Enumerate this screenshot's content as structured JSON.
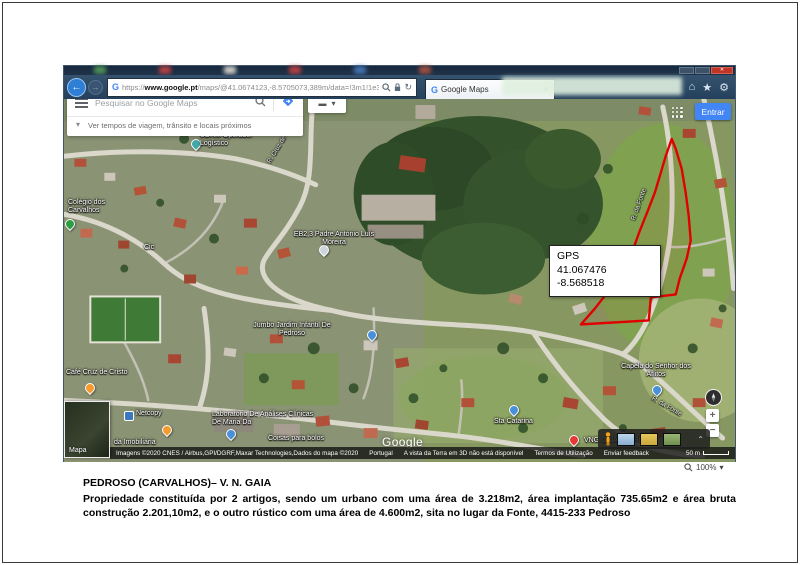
{
  "browser": {
    "url_scheme": "https://",
    "url_domain": "www.google.pt",
    "url_path": "/maps/@41.0674123,-8.5705073,389m/data=!3m1!1e3?hl=pt-PT",
    "tab_title": "Google Maps",
    "icons": {
      "refresh": "↻",
      "home": "⌂",
      "star": "★",
      "gear": "⚙",
      "caret": "▾",
      "tab_close": "✕",
      "window_close": "✕",
      "back_arrow": "←",
      "fwd_arrow": "→",
      "chevron_up": "⌃",
      "chevron_down": "▾",
      "dash": "▬"
    }
  },
  "maps_ui": {
    "search_placeholder": "Pesquisar no Google Maps",
    "travel_hint": "Ver tempos de viagem, trânsito e locais próximos",
    "signin_label": "Entrar",
    "map_inset_label": "Mapa",
    "watermark": "Google",
    "zoom_in": "+",
    "zoom_out": "−",
    "attribution_imagery": "Imagens ©2020 CNES / Airbus,GPI/DGRF,Maxar Technologies,Dados do mapa ©2020",
    "attribution_country": "Portugal",
    "attribution_3d": "A vista da Terra em 3D não está disponível",
    "terms": "Termos de Utilização",
    "feedback": "Enviar feedback",
    "scale": "50 m",
    "ie_zoom_level": "100%"
  },
  "gps_box": {
    "title": "GPS",
    "lat": "41.067476",
    "lng": "-8.568518"
  },
  "map_labels": [
    {
      "text": "UDHM Operador Logístico"
    },
    {
      "text": "R. Cruz de Carrais"
    },
    {
      "text": "EB2,3 Padre António Luís Moreira"
    },
    {
      "text": "Jumbo Jardim Infantil De Pedroso"
    },
    {
      "text": "Café Cruz de Cristo"
    },
    {
      "text": "Netcopy"
    },
    {
      "text": "Laboratório De Análises Clínicas De Maria Da"
    },
    {
      "text": "Coisas para bolos"
    },
    {
      "text": "da Imobiliária"
    },
    {
      "text": "Sta Catarina"
    },
    {
      "text": "Capela do Senhor dos Aflitos"
    },
    {
      "text": "VNG GAIA PEDROSO"
    },
    {
      "text": "R. da Fonte"
    },
    {
      "text": "R. da Fonte"
    },
    {
      "text": "Colégio dos Carvalhos"
    },
    {
      "text": "Cic"
    }
  ],
  "caption": {
    "title": "PEDROSO  (CARVALHOS)– V. N. GAIA",
    "body": "Propriedade constituída por 2 artigos, sendo um urbano com uma área de 3.218m2, área implantação 735.65m2 e área bruta construção 2.201,10m2, e o outro rústico com uma área de 4.600m2, sita no lugar da Fonte, 4415-233 Pedroso"
  },
  "colors": {
    "accent_blue": "#4285f4",
    "polygon_red": "#e00000"
  }
}
